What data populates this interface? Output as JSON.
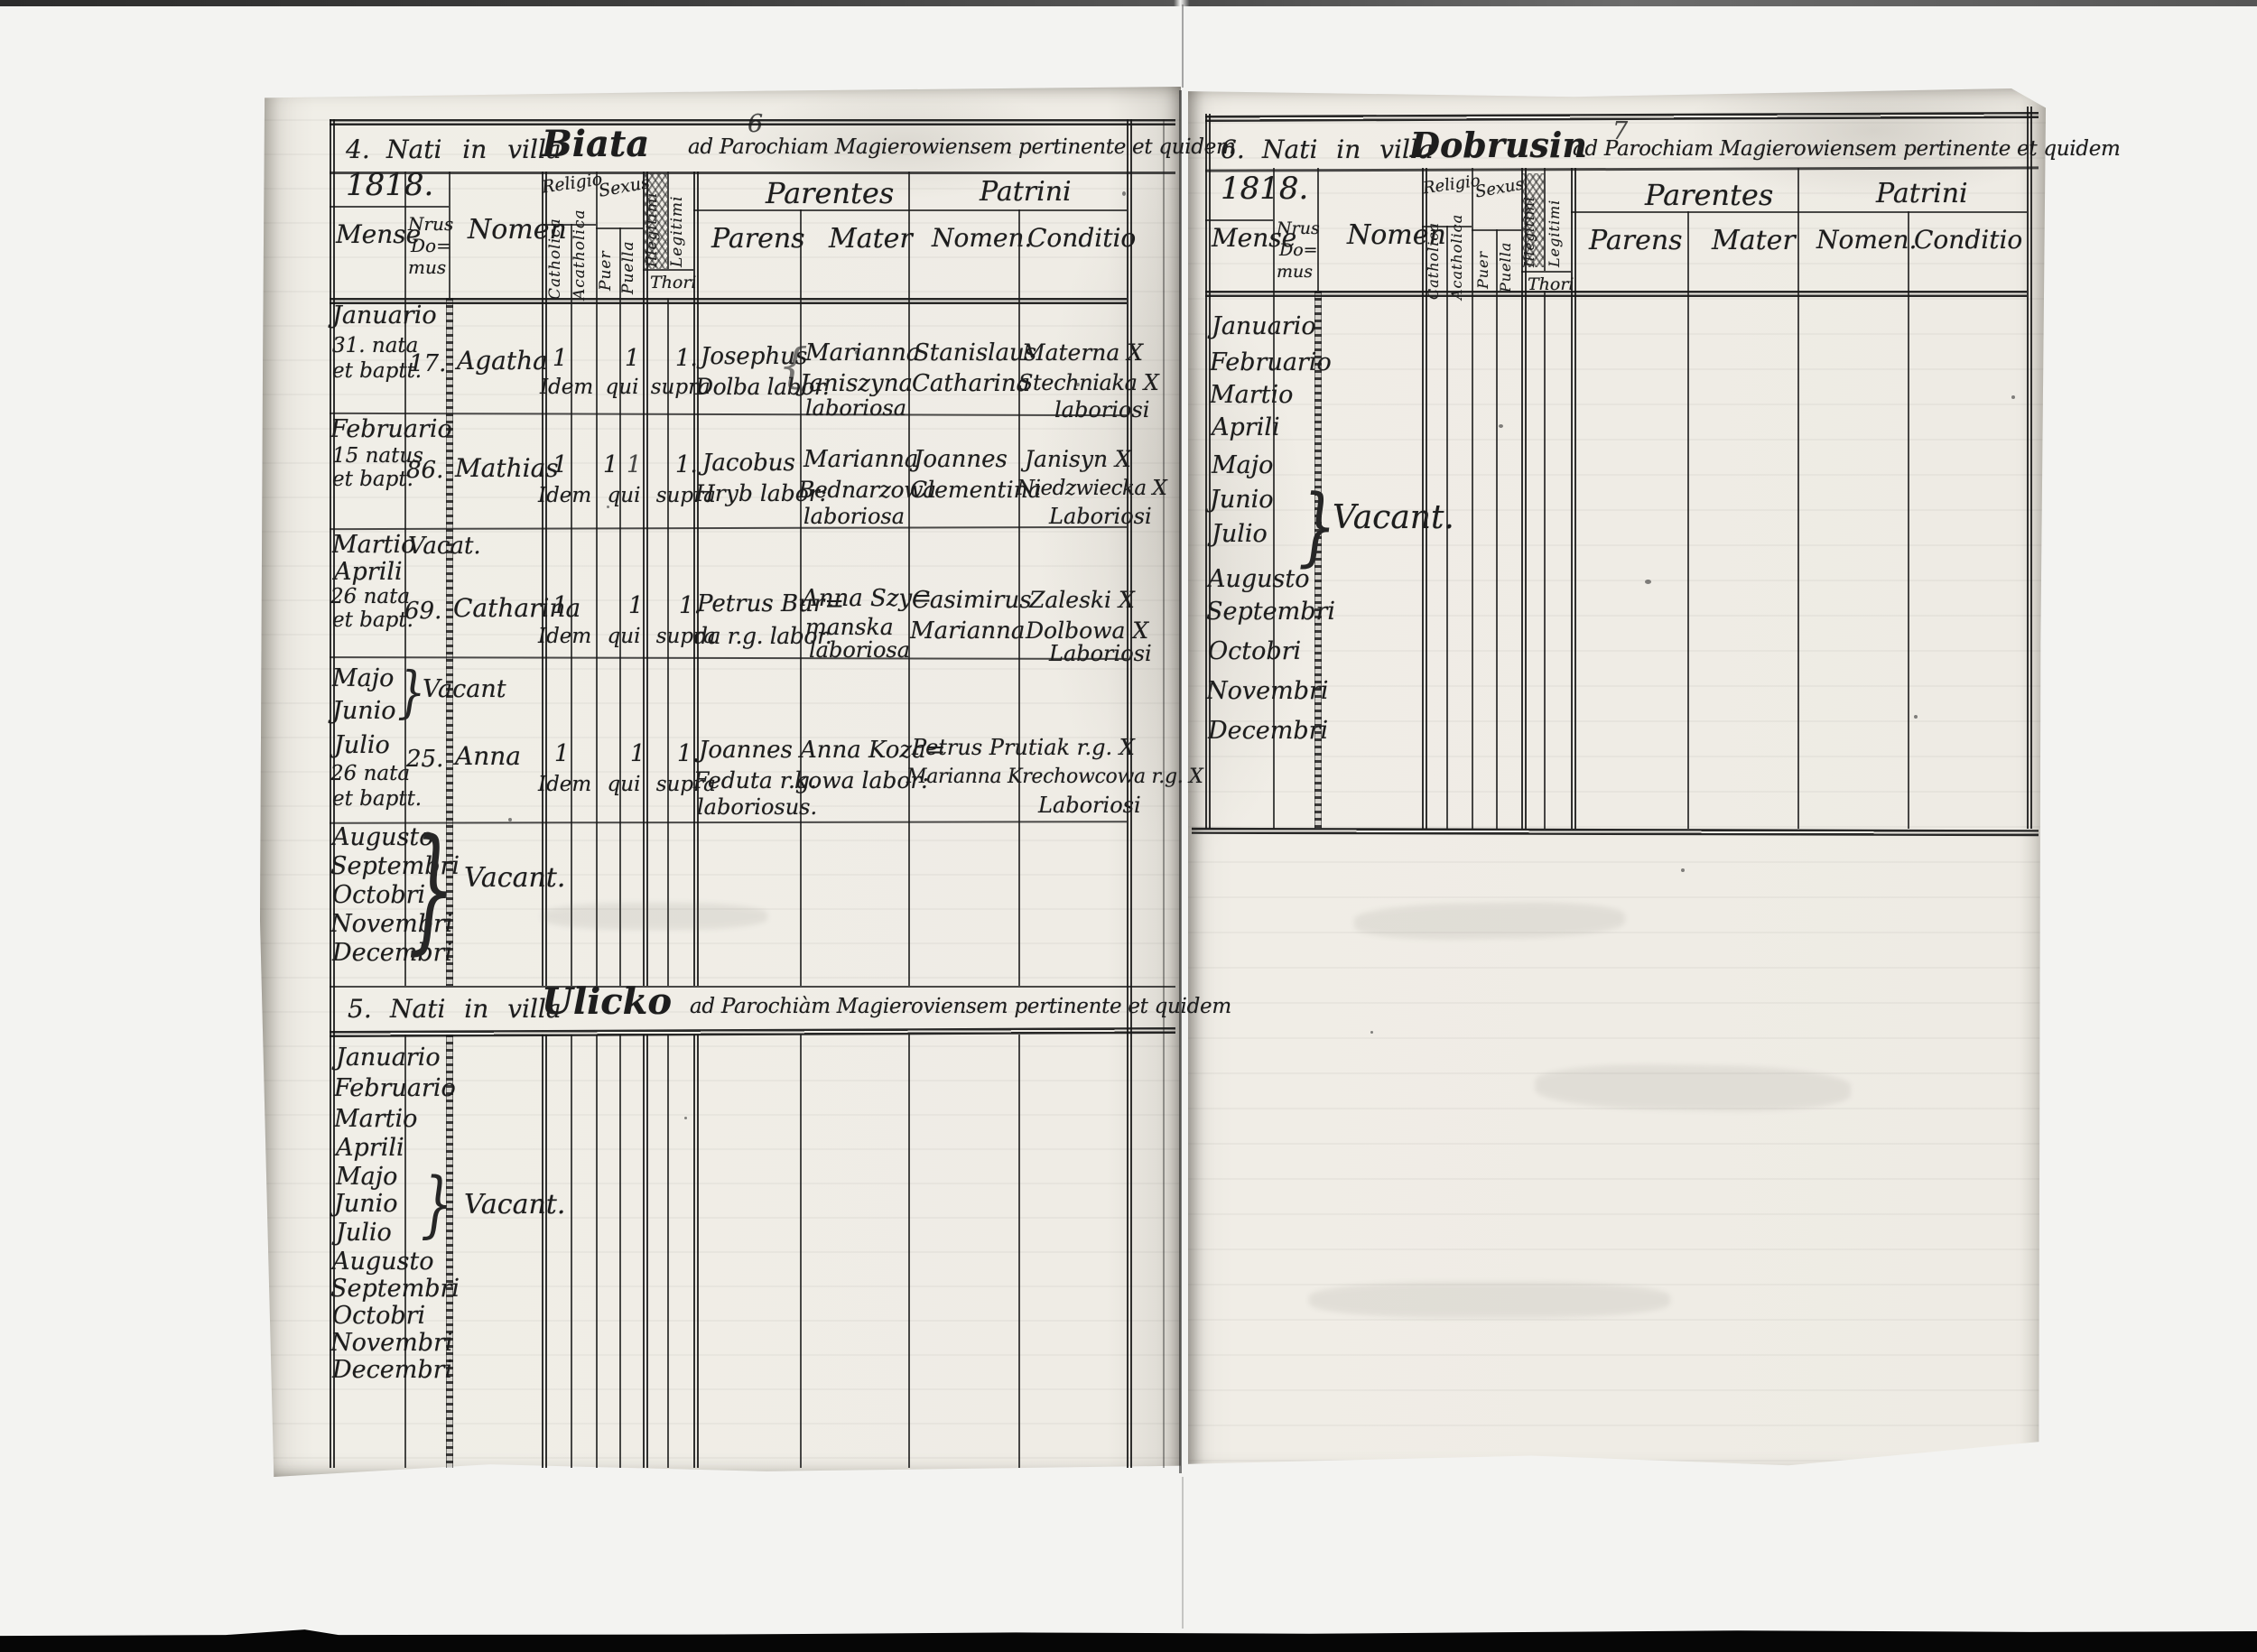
{
  "scan": {
    "ink_color": "#1c1c1c",
    "paper_color": "#f0eee8",
    "page_number_left": "6",
    "page_number_right": "7"
  },
  "headers": {
    "year": "1818.",
    "mense": "Mense",
    "nrus": "Nrus",
    "do_": "Do=",
    "mus": "mus",
    "nomen": "Nomen",
    "religio": "Religio",
    "catholica": "Catholica",
    "acatholica": "Acatholica",
    "sexus": "Sexus",
    "puer": "Puer",
    "puella": "Puella",
    "illegitimi": "Illegitimi",
    "legitimi": "Legitimi",
    "thori": "Thori",
    "parentes": "Parentes",
    "parens": "Parens",
    "mater": "Mater",
    "patrini": "Patrini",
    "patrini_nomen": "Nomen.",
    "conditio": "Conditio"
  },
  "left": {
    "title": {
      "num": "4.",
      "pre": "Nati in villa",
      "villa": "Biata",
      "post": "ad Parochiam Magierowiensem pertinente et quidem"
    },
    "rows": [
      {
        "m1": "Januario",
        "m2": "31. nata",
        "m3": "et baptt.",
        "domus": "17.",
        "nomen": "Agatha",
        "k1": "1",
        "k2": "1",
        "k3": "1.",
        "idem": "Idem qui supra",
        "p1": "Josephus",
        "p2": "Dolba labor.",
        "mt1": "Marianna",
        "mt2": "Janiszyna",
        "mt3": "laboriosa",
        "n1": "Stanislaus",
        "n2": "Catharina",
        "c1": "Materna X",
        "c2": "Stechniaka X",
        "c3": "laboriosi"
      },
      {
        "m1": "Februario",
        "m2": "15 natus",
        "m3": "et bapt.",
        "domus": "86.",
        "nomen": "Mathias",
        "k1": "1",
        "k2": "1",
        "k2b": "1",
        "k3": "1.",
        "idem": "Idem qui supra",
        "p1": "Jacobus",
        "p2": "Hryb labor:",
        "mt1": "Marianna",
        "mt2": "Bednarzowa",
        "mt3": "laboriosa",
        "n1": "Joannes",
        "n2": "Clementina",
        "c1": "Janisyn X",
        "c2": "Niedzwiecka X",
        "c3": "Laboriosi"
      },
      {
        "vacat_month": "Martio",
        "vacat": "Vacat.",
        "m1": "Aprili",
        "m2": "26 nata",
        "m3": "et bapt.",
        "domus": "69.",
        "nomen": "Catharina",
        "k1": "1",
        "k2": "1",
        "k3": "1.",
        "idem": "Idem qui supra",
        "p1": "Petrus Bur=",
        "p2": "da r.g. labor.",
        "mt1": "Anna Szy=",
        "mt2": "manska",
        "mt3": "laboriosa",
        "n1": "Casimirus",
        "n2": "Marianna",
        "c1": "Zaleski X",
        "c2": "Dolbowa X",
        "c3": "Laboriosi"
      },
      {
        "vm1": "Majo",
        "vm2": "Junio",
        "vacant": "Vacant",
        "m1": "Julio",
        "m2": "26 nata",
        "m3": "et baptt.",
        "domus": "25.",
        "nomen": "Anna",
        "k1": "1",
        "k2": "1",
        "k3": "1.",
        "idem": "Idem qui supra",
        "p1": "Joannes",
        "p2": "Feduta r.g.",
        "p3": "laboriosus.",
        "mt1": "Anna Koza=",
        "mt2": "kowa labor:",
        "w1": "Petrus Prutiak r.g. X",
        "w2": "Marianna Krechowcowa r.g. X",
        "w3": "Laboriosi"
      },
      {
        "months": [
          "Augusto",
          "Septembri",
          "Octobri",
          "Novembri",
          "Decembri"
        ],
        "vacant": "Vacant."
      }
    ],
    "section5": {
      "title": {
        "num": "5.",
        "pre": "Nati in villa",
        "villa": "Ulicko",
        "post": "ad Parochiàm Magieroviensem pertinente et quidem"
      },
      "months": [
        "Januario",
        "Februario",
        "Martio",
        "Aprili",
        "Majo",
        "Junio",
        "Julio",
        "Augusto",
        "Septembri",
        "Octobri",
        "Novembri",
        "Decembri"
      ],
      "vacant": "Vacant."
    }
  },
  "right": {
    "title": {
      "num": "6.",
      "pre": "Nati in villa",
      "villa": "Dobrusin",
      "post": "ad Parochiam Magierowiensem pertinente et quidem"
    },
    "months": [
      "Januario",
      "Februario",
      "Martio",
      "Aprili",
      "Majo",
      "Junio",
      "Julio",
      "Augusto",
      "Septembri",
      "Octobri",
      "Novembri",
      "Decembri"
    ],
    "vacant": "Vacant."
  }
}
